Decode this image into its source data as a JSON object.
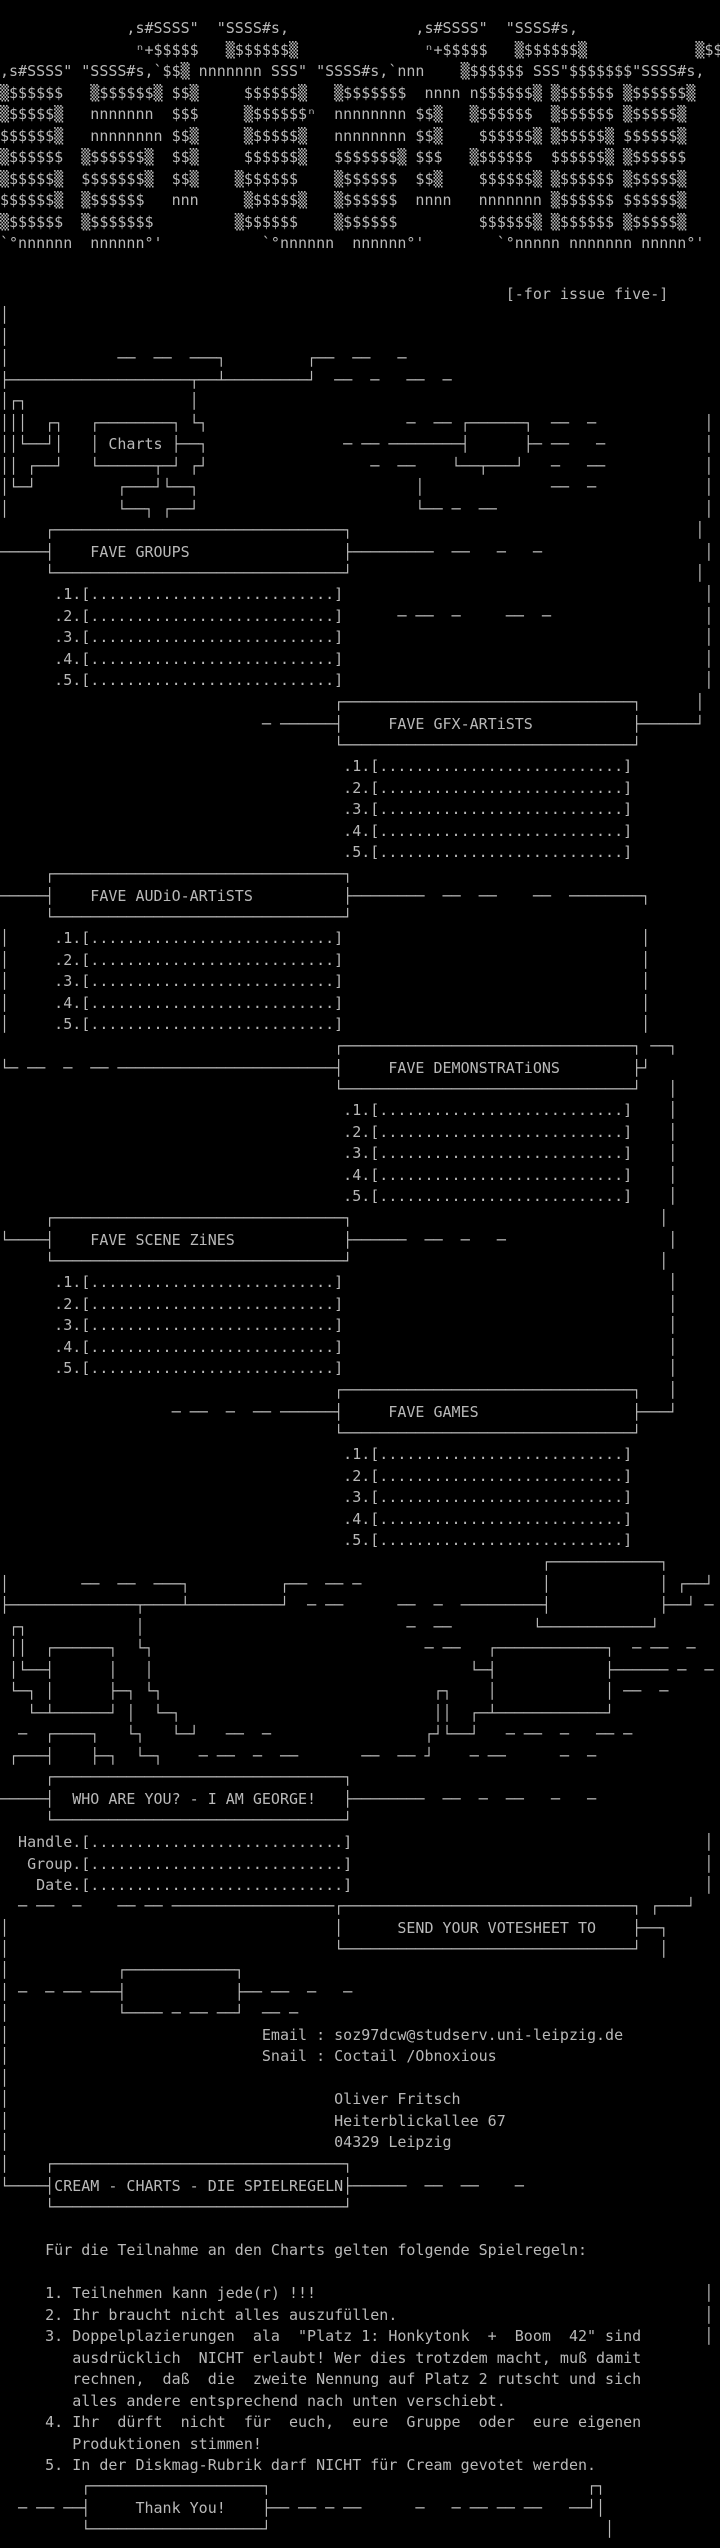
{
  "page": {
    "background": "#000000",
    "foreground": "#b9b9b9"
  },
  "logo": {
    "description": "CREAM ascii-art logo",
    "lines": [
      "              ,s#SSSS\"  \"SSSS#s,              ,s#SSSS\"  \"SSSS#s,",
      "               ⁿ+$$$$$   ▒$$$$$$▒              ⁿ+$$$$$   ▒$$$$$$▒            ▒$$",
      ",s#SSSS\" \"SSSS#s,`$$▒ nnnnnnn SSS\" \"SSSS#s,`nnn    ▒$$$$$$ SSS\"$$$$$$$\"SSSS#s,",
      "▒$$$$$$   ▒$$$$$$▒ $$▒     $$$$$$▒   ▒$$$$$$$  nnnn n$$$$$$▒ ▒$$$$$$ ▒$$$$$$▒",
      "▒$$$$$▒   nnnnnnn  $$$     ▒$$$$$$ⁿ  nnnnnnnn $$▒   ▒$$$$$$  ▒$$$$$$ ▒$$$$$▒",
      "$$$$$$▒   nnnnnnnn $$▒     ▒$$$$$▒   nnnnnnnn $$▒    $$$$$$▒ ▒$$$$$▒ $$$$$$▒",
      "▒$$$$$$  ▒$$$$$$▒  $$▒     $$$$$$▒   $$$$$$$▒ $$$   ▒$$$$$$  $$$$$$▒ ▒$$$$$$",
      "▒$$$$$▒  $$$$$$$▒  $$▒    ▒$$$$$$    ▒$$$$$$  $$▒    $$$$$$▒ ▒$$$$$$ ▒$$$$$▒",
      "$$$$$$▒  ▒$$$$$$   nnn     ▒$$$$$▒   ▒$$$$$$  nnnn   nnnnnnn ▒$$$$$$ $$$$$$▒",
      "▒$$$$$$  ▒$$$$$$$         ▒$$$$$$    ▒$$$$$$         $$$$$$▒ ▒$$$$$$ ▒$$$$$▒",
      "`°nnnnnn  nnnnnn°'           `°nnnnnn  nnnnnn°'        `°nnnnn nnnnnnn nnnnn°'"
    ]
  },
  "issue_note": {
    "text": "[-for issue five-]",
    "line": "                                                        [-for issue five-]"
  },
  "decor_top": {
    "lines": [
      "│",
      "│",
      "│            ──  ──  ───┐         ┌──  ──   ─",
      "├────────────────────┬──┴─────────┘  ──  ─   ──  ─"
    ]
  },
  "charts_cluster": {
    "label": "Charts",
    "lines": [
      "│┌┐                  │",
      "│││  ┌┐   ┌────────┐ └┐                      ─  ── ┌──────┐  ──  ─            │",
      "││└──┘│   │ Charts ├──┐               ─ ── ────────┤      ├─ ──   ─           │",
      "││ ┌──┘   └──────┬─┘ ┌┘                  ─  ──    └──┬───┘   ─   ──           │",
      "│└─┘         ┌───┘└──┐                        │              ──  ─            │",
      "│            └──┐ ┌──┘                        └── ─  ──                       │"
    ]
  },
  "sections": {
    "groups": {
      "title": "FAVE GROUPS",
      "box": [
        "     ┌────────────────────────────────┐                                      │",
        "─────┤    FAVE GROUPS                 ├─────────  ──   ─   ─                  │",
        "     └────────────────────────────────┘                                      │"
      ],
      "items": [
        "      .1.[...........................]                                        │",
        "      .2.[...........................]      ─ ──  ─     ──  ─                 │",
        "      .3.[...........................]                                        │",
        "      .4.[...........................]                                        │",
        "      .5.[...........................]                                        │"
      ]
    },
    "gfx": {
      "title": "FAVE GFX-ARTiSTS",
      "box": [
        "                                     ┌────────────────────────────────┐      │",
        "                             ─ ──────┤     FAVE GFX-ARTiSTS           ├──────┘",
        "                                     └────────────────────────────────┘"
      ],
      "items": [
        "                                      .1.[...........................]",
        "                                      .2.[...........................]",
        "                                      .3.[...........................]",
        "                                      .4.[...........................]",
        "                                      .5.[...........................]"
      ]
    },
    "audio": {
      "title": "FAVE AUDiO-ARTiSTS",
      "box": [
        "     ┌────────────────────────────────┐",
        "─────┤    FAVE AUDiO-ARTiSTS          ├────────  ──  ──    ──  ────────┐",
        "     └────────────────────────────────┘"
      ],
      "items": [
        "│     .1.[...........................]                                 │",
        "│     .2.[...........................]                                 │",
        "│     .3.[...........................]                                 │",
        "│     .4.[...........................]                                 │",
        "│     .5.[...........................]                                 │"
      ]
    },
    "demos": {
      "title": "FAVE DEMONSTRATiONS",
      "box": [
        "                                     ┌────────────────────────────────┐ ──┐",
        "└─ ──  ─  ── ────────────────────────┤     FAVE DEMONSTRATiONS        ├┘",
        "                                     └────────────────────────────────┘   │"
      ],
      "items": [
        "                                      .1.[...........................]    │",
        "                                      .2.[...........................]    │",
        "                                      .3.[...........................]    │",
        "                                      .4.[...........................]    │",
        "                                      .5.[...........................]    │"
      ]
    },
    "zines": {
      "title": "FAVE SCENE ZiNES",
      "box": [
        "     ┌────────────────────────────────┐                                  │",
        "└────┤    FAVE SCENE ZiNES            ├──────  ──  ─   ─                  │",
        "     └────────────────────────────────┘                                  │"
      ],
      "items": [
        "      .1.[...........................]                                    │",
        "      .2.[...........................]                                    │",
        "      .3.[...........................]                                    │",
        "      .4.[...........................]                                    │",
        "      .5.[...........................]                                    │"
      ]
    },
    "games": {
      "title": "FAVE GAMES",
      "box": [
        "                                     ┌────────────────────────────────┐   │",
        "                   ─ ──  ─  ── ──────┤     FAVE GAMES                 ├───┘",
        "                                     └────────────────────────────────┘"
      ],
      "items": [
        "                                      .1.[...........................]",
        "                                      .2.[...........................]",
        "                                      .3.[...........................]",
        "                                      .4.[...........................]",
        "                                      .5.[...........................]"
      ]
    }
  },
  "decor_mid": {
    "lines": [
      "                                                            ┌────────────┐",
      "│        ──  ──  ───┐          ┌──  ── ─                    │            │ ┌──┘",
      "├──────────────┬────┴──────────┘  ─ ──      ──  ─  ─────────┤            ├──┘ ─",
      " ┌┐            │                             ─  ──         └────────────┘",
      " ││  ┌──────┐  └┐                              ─ ──   ┌────────────┐  ─ ──  ─",
      " │└──┤      │   │                                   └─┤            ├────── ─  ─",
      " └─┐ │      ├─┐ └┐                              ┌┐    │            │ ──  ─",
      "   └─┴──────┘ │  └─┐                            ││  ┌─┴────────────┘",
      "  ─  ┌────┐   └┐   └─┘   ──  ─                 ┌┘└──┘   ─ ──  ─   ── ─",
      " ┌───┤    ├─┐  └─┐    ─ ──  ─  ──       ──  ── ┘    ─ ──      ─  ─"
    ]
  },
  "who": {
    "title": "WHO ARE YOU? - I AM GEORGE!",
    "box": [
      "     ┌────────────────────────────────┐",
      "─────┤  WHO ARE YOU? - I AM GEORGE!   ├────────  ──  ─  ──   ─   ─",
      "     └────────────────────────────────┘"
    ],
    "fields": [
      "  Handle.[............................]                                       │",
      "   Group.[............................]                                       │",
      "    Date.[............................]                                       │"
    ]
  },
  "send": {
    "title": "SEND YOUR VOTESHEET TO",
    "box": [
      "  ─ ──  ─    ── ── ──────────────────┌────────────────────────────────┐ ┌───┘",
      "│                                    │      SEND YOUR VOTESHEET TO    ├──┐",
      "│                                    └────────────────────────────────┘  │"
    ]
  },
  "contact": {
    "email": "soz97dcw@studserv.uni-leipzig.de",
    "snail": "Coctail /Obnoxious",
    "name": "Oliver Fritsch",
    "street": "Heiterblickallee 67",
    "city": "04329 Leipzig",
    "lines": [
      "│            ┌────────────┐",
      "│ ─  ─ ── ───┤            ├── ──  ─   ─",
      "│            └──── ─ ── ──┘  ── ─",
      "│                            Email : soz97dcw@studserv.uni-leipzig.de",
      "│                            Snail : Coctail /Obnoxious",
      "│",
      "│                                    Oliver Fritsch",
      "│                                    Heiterblickallee 67",
      "│                                    04329 Leipzig"
    ]
  },
  "rules": {
    "title": "CREAM - CHARTS - DIE SPIELREGELN",
    "box": [
      "│    ┌────────────────────────────────┐",
      "└────┤CREAM - CHARTS - DIE SPIELREGELN├──────  ──  ──    ─",
      "     └────────────────────────────────┘"
    ],
    "intro": "Für die Teilnahme an den Charts gelten folgende Spielregeln:",
    "text_lines": [
      "     Für die Teilnahme an den Charts gelten folgende Spielregeln:",
      "",
      "     1. Teilnehmen kann jede(r) !!!                                           │",
      "     2. Ihr braucht nicht alles auszufüllen.                                  │",
      "     3. Doppelplazierungen  ala  \"Platz 1: Honkytonk  +  Boom  42\" sind       │",
      "        ausdrücklich  NICHT erlaubt! Wer dies trotzdem macht, muß damit",
      "        rechnen,  daß  die  zweite Nennung auf Platz 2 rutscht und sich",
      "        alles andere entsprechend nach unten verschiebt.",
      "     4. Ihr  dürft  nicht  für  euch,  eure  Gruppe  oder  eure eigenen",
      "        Produktionen stimmen!",
      "     5. In der Diskmag-Rubrik darf NICHT für Cream gevotet werden."
    ]
  },
  "thanks": {
    "label": "Thank You!",
    "lines": [
      "         ┌───────────────────┐                                   ┌┐",
      "  ─ ── ──┤     Thank You!    ├── ── ─ ──      ─   ─ ── ── ──   ──┘│",
      "         └───────────────────┘                                     │"
    ]
  }
}
